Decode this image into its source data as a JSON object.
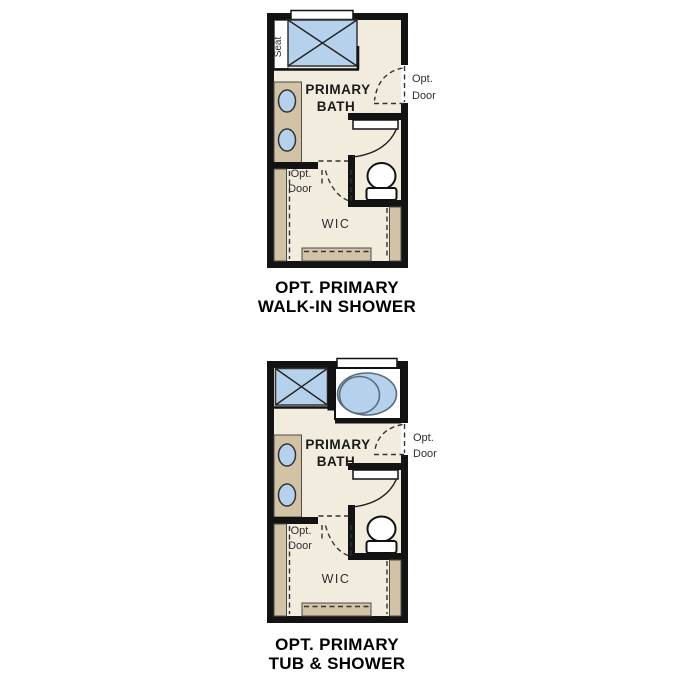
{
  "sheet": {
    "background": "#ffffff"
  },
  "colors": {
    "wall": "#131313",
    "floor": "#f2ecdf",
    "cabinetry": "#d2c3a6",
    "fixture_blue": "#b5d1ec",
    "outline_gray": "#4b4b4b"
  },
  "plans": [
    {
      "name": "opt-primary-walk-in-shower",
      "caption": {
        "line1": "OPT. PRIMARY",
        "line2": "WALK-IN SHOWER"
      },
      "labels": {
        "seat": "Seat",
        "room_line1": "PRIMARY",
        "room_line2": "BATH",
        "entry_opt_door_line1": "Opt.",
        "entry_opt_door_line2": "Door",
        "wic_opt_door_line1": "Opt.",
        "wic_opt_door_line2": "Door",
        "closet": "WIC"
      }
    },
    {
      "name": "opt-primary-tub-and-shower",
      "caption": {
        "line1": "OPT. PRIMARY",
        "line2": "TUB & SHOWER"
      },
      "labels": {
        "room_line1": "PRIMARY",
        "room_line2": "BATH",
        "entry_opt_door_line1": "Opt.",
        "entry_opt_door_line2": "Door",
        "wic_opt_door_line1": "Opt.",
        "wic_opt_door_line2": "Door",
        "closet": "WIC"
      }
    }
  ]
}
